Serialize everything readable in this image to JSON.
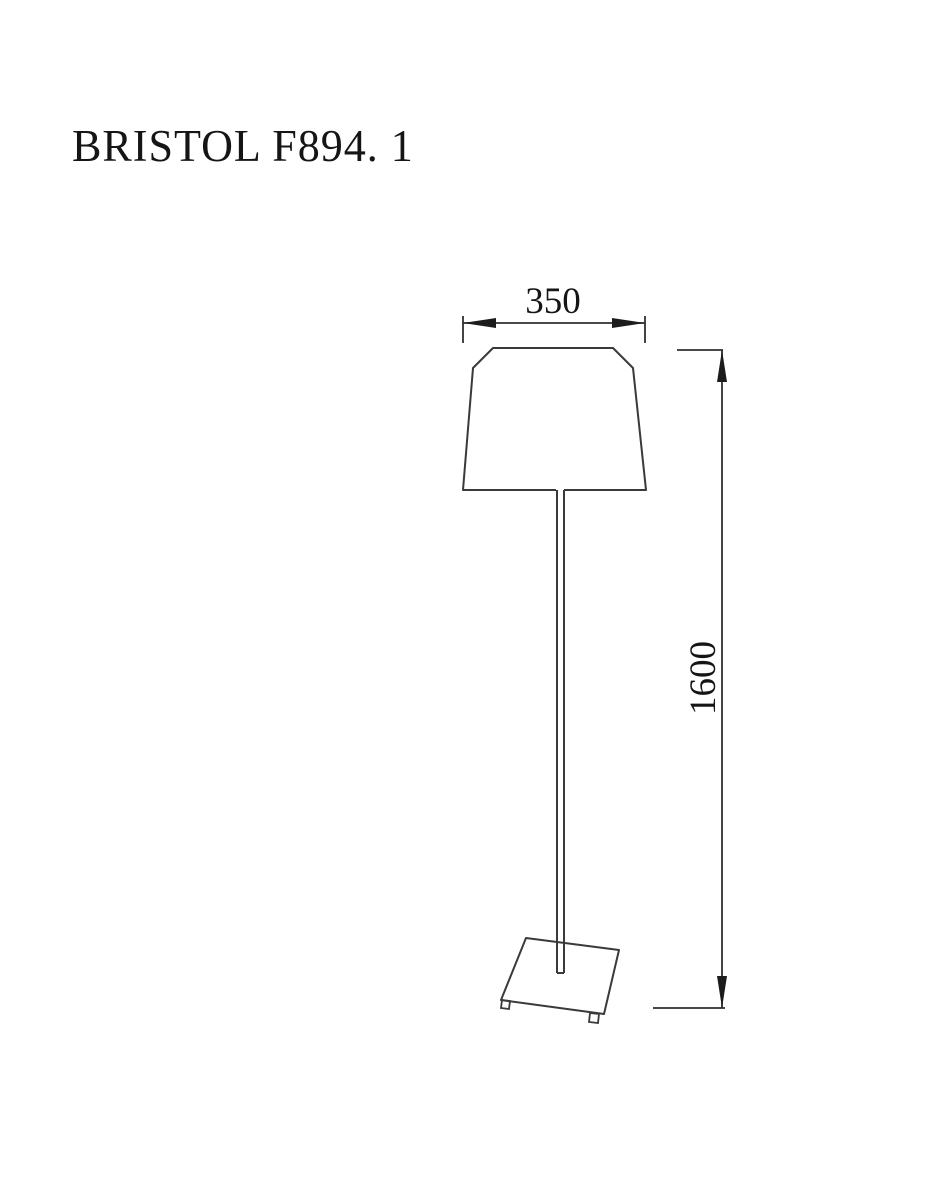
{
  "title": "BRISTOL F894. 1",
  "drawing": {
    "subject": "floor-lamp",
    "dimension_labels": {
      "shade_width": "350",
      "overall_height": "1600"
    }
  },
  "colors": {
    "background": "#ffffff",
    "line": "#3a3a3a",
    "dimension_line": "#2f2f2f",
    "text": "#151515"
  }
}
